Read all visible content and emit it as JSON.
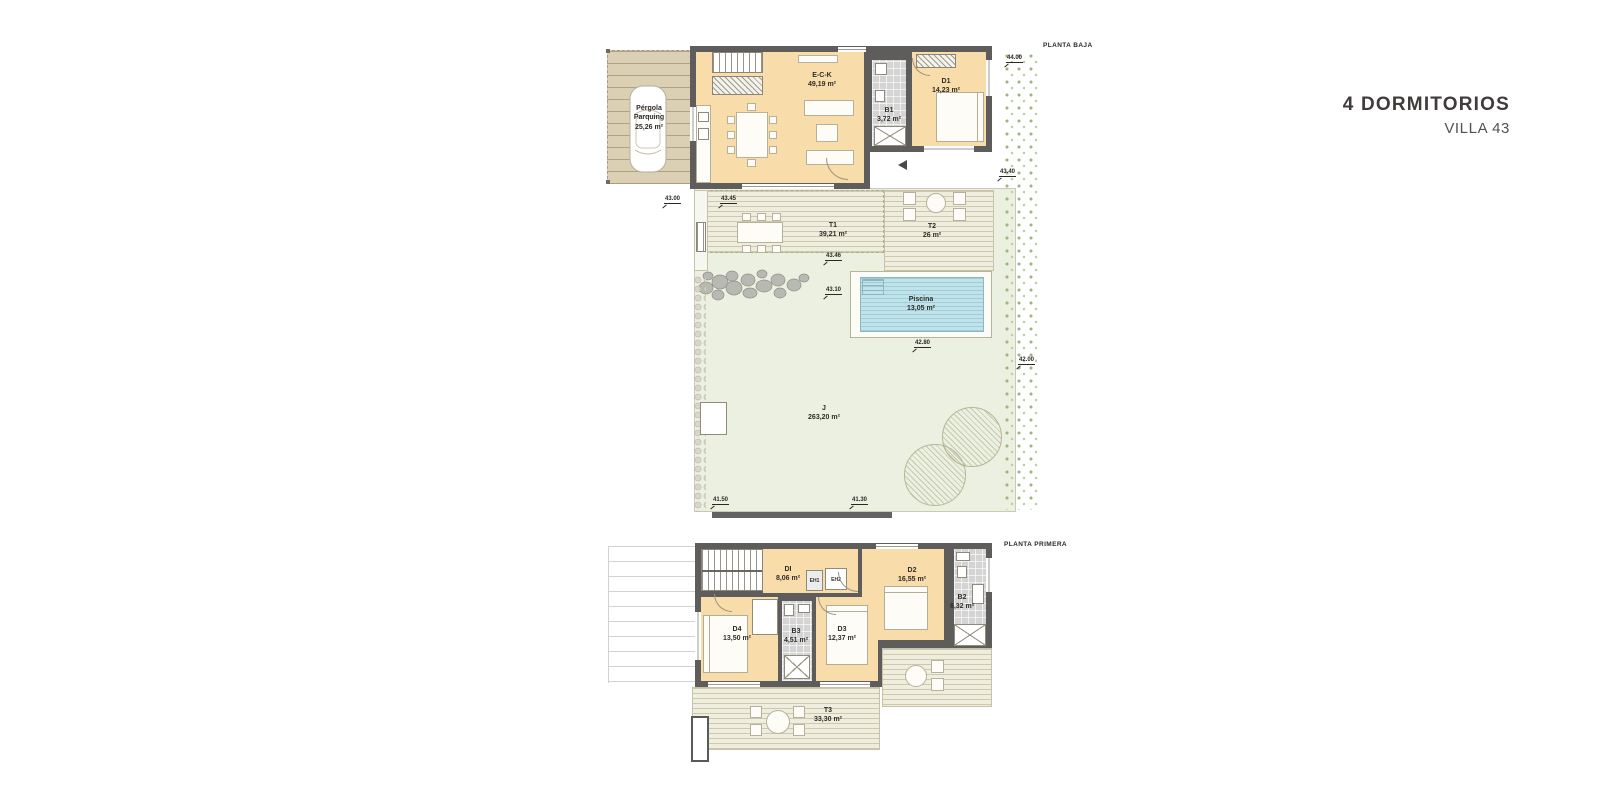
{
  "title": {
    "main": "4 DORMITORIOS",
    "sub": "VILLA 43"
  },
  "palette": {
    "room_fill": "#f8dcaa",
    "wall": "#5f5d5b",
    "deck": "#efeede",
    "garden": "#ecf0e0",
    "pool_water": "#bfe3ea",
    "pergola": "#dbcfb4",
    "bath_tile": "#d4d4d4",
    "vegetation": "#9db581",
    "text": "#2e2c29"
  },
  "floors": {
    "baja": {
      "label": "PLANTA BAJA",
      "rooms": {
        "pergola": {
          "name1": "Pérgola",
          "name2": "Parquing",
          "area": "25,26 m²"
        },
        "eck": {
          "name": "E-C-K",
          "area": "49,19 m²"
        },
        "b1": {
          "name": "B1",
          "area": "3,72 m²"
        },
        "d1": {
          "name": "D1",
          "area": "14,23 m²"
        },
        "t1": {
          "name": "T1",
          "area": "39,21 m²"
        },
        "t2": {
          "name": "T2",
          "area": "26 m²"
        },
        "piscina": {
          "name": "Piscina",
          "area": "13,05 m²"
        },
        "jardin": {
          "name": "J",
          "area": "263,20 m²"
        }
      },
      "levels": [
        "44.00",
        "43.40",
        "43.00",
        "43.45",
        "43.46",
        "43.10",
        "42.80",
        "42.00",
        "41.50",
        "41.30"
      ]
    },
    "primera": {
      "label": "PLANTA PRIMERA",
      "rooms": {
        "d": {
          "name": "DI",
          "area": "8,06 m²"
        },
        "eh1": {
          "name": "EH1"
        },
        "eh2": {
          "name": "EH2"
        },
        "d2": {
          "name": "D2",
          "area": "16,55 m²"
        },
        "b2": {
          "name": "B2",
          "area": "6,32 m²"
        },
        "d4": {
          "name": "D4",
          "area": "13,50 m²"
        },
        "b3": {
          "name": "B3",
          "area": "4,51 m²"
        },
        "d3": {
          "name": "D3",
          "area": "12,37 m²"
        },
        "t3": {
          "name": "T3",
          "area": "33,30 m²"
        }
      }
    }
  }
}
